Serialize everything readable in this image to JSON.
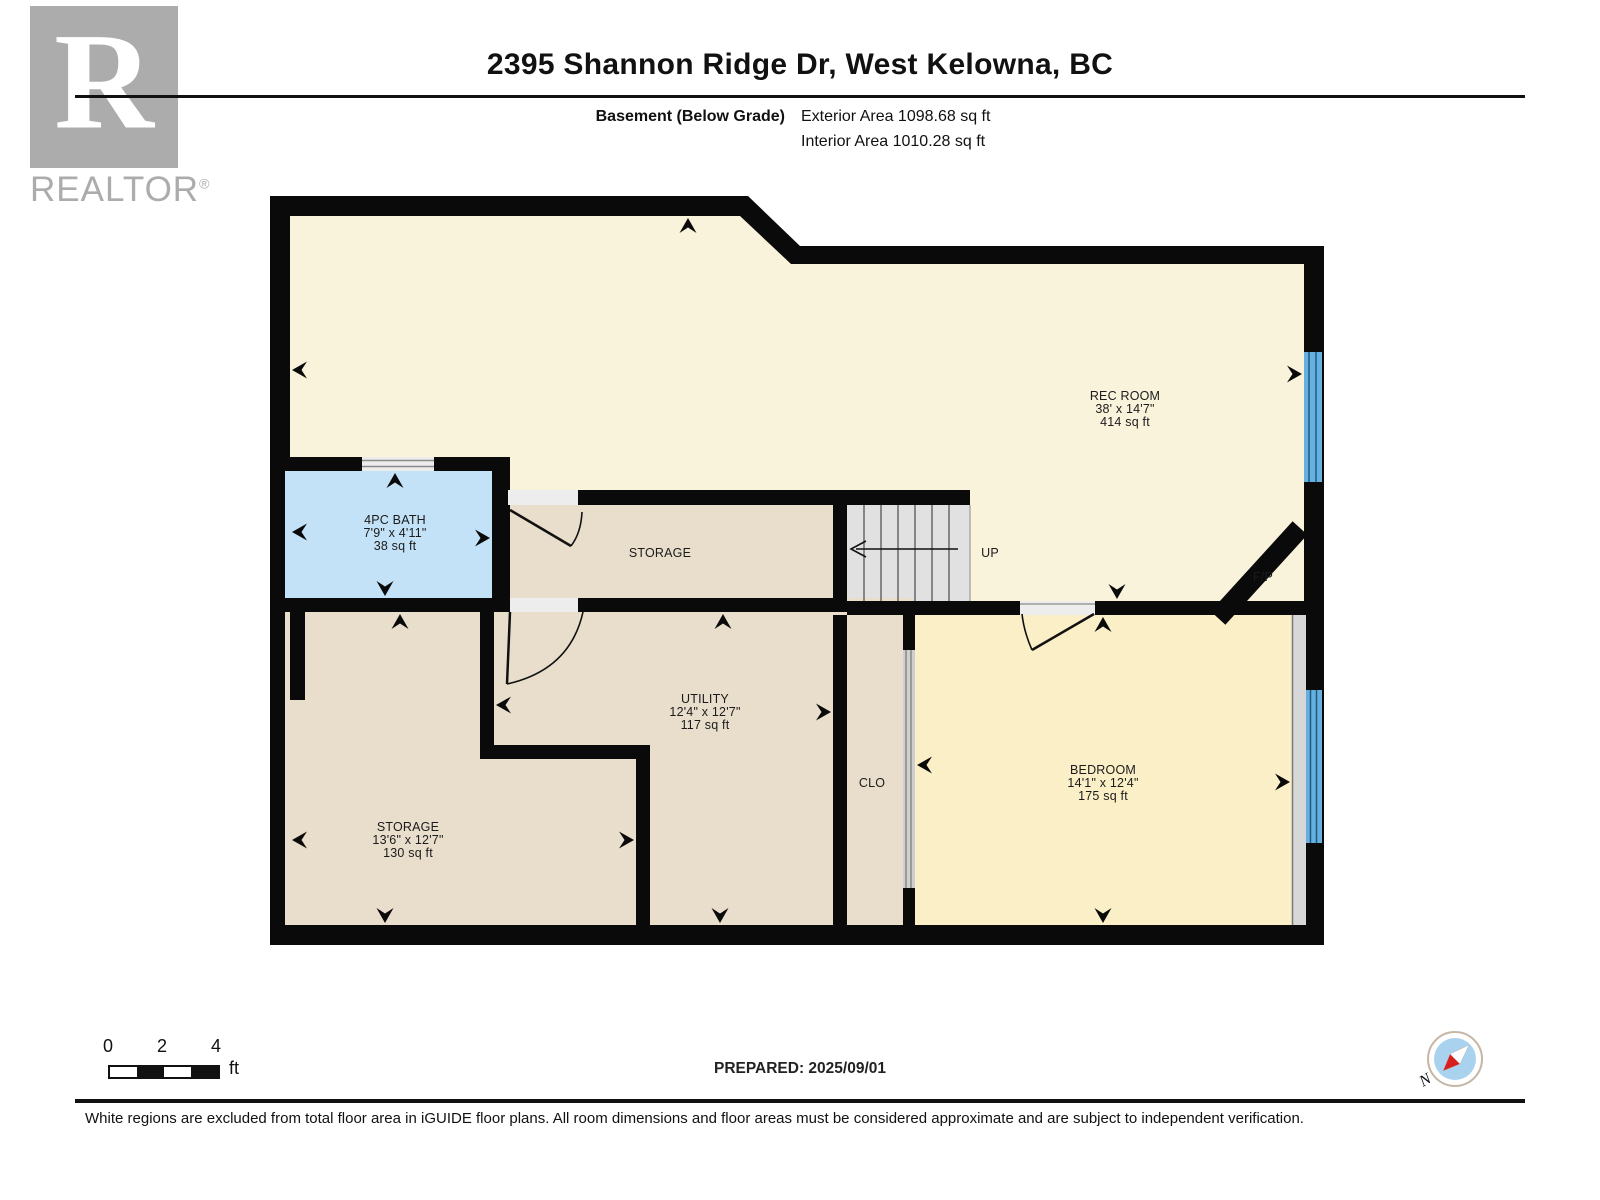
{
  "header": {
    "title": "2395 Shannon Ridge Dr, West Kelowna, BC",
    "floor_label": "Basement (Below Grade)",
    "exterior_area": "Exterior Area 1098.68 sq ft",
    "interior_area": "Interior Area 1010.28 sq ft"
  },
  "watermark": {
    "letter": "R",
    "brand": "REALTOR",
    "registered": "®"
  },
  "plan": {
    "rooms": {
      "rec": {
        "name": "REC ROOM",
        "dims": "38' x 14'7\"",
        "area": "414 sq ft"
      },
      "bath": {
        "name": "4PC BATH",
        "dims": "7'9\" x 4'11\"",
        "area": "38 sq ft"
      },
      "storage_mid": {
        "name": "STORAGE"
      },
      "utility": {
        "name": "UTILITY",
        "dims": "12'4\" x 12'7\"",
        "area": "117 sq ft"
      },
      "storage": {
        "name": "STORAGE",
        "dims": "13'6\" x 12'7\"",
        "area": "130 sq ft"
      },
      "bedroom": {
        "name": "BEDROOM",
        "dims": "14'1\" x 12'4\"",
        "area": "175 sq ft"
      },
      "closet": {
        "label": "CLO"
      },
      "stairs": {
        "label": "UP"
      },
      "fireplace": {
        "label": "F/P"
      }
    }
  },
  "scale_bar": {
    "ticks": [
      "0",
      "2",
      "4"
    ],
    "unit": "ft"
  },
  "compass": {
    "north_label": "N"
  },
  "footer": {
    "prepared": "PREPARED: 2025/09/01",
    "disclaimer": "White regions are excluded from total floor area in iGUIDE floor plans. All room dimensions and floor areas must be considered approximate and are subject to independent verification."
  },
  "colors": {
    "rec_room_floor": "#FAF3DC",
    "bedroom_floor": "#FBEFC7",
    "storage_floor": "#E8DECB",
    "bath_floor": "#C3E2F7",
    "window_blue": "#64B1E0",
    "stairs_gray": "#E1E1E1",
    "wall_black": "#0A0A0A",
    "watermark_gray": "#ACACAC",
    "compass_blue": "#A9D2EE",
    "compass_needle_red": "#D81E1E"
  }
}
